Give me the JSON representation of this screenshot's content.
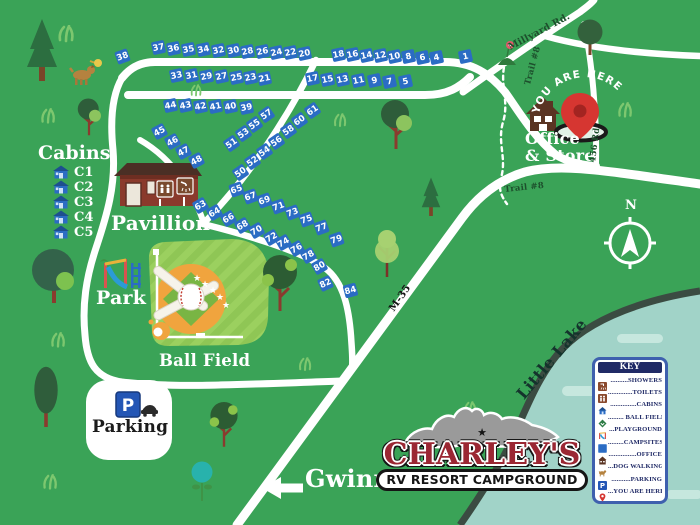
{
  "map": {
    "background_color": "#3aa357",
    "road_color": "#ffffff",
    "campsite_color": "#2b6cc4",
    "lake_fill": "#a1d3c8",
    "lake_shore": "#3b4b42"
  },
  "logo": {
    "name": "CHARLEY'S",
    "tagline": "RV RESORT CAMPGROUND",
    "color": "#9b2733"
  },
  "you_are_here": "YOU ARE HERE",
  "cabins": {
    "title": "Cabins",
    "items": [
      "C1",
      "C2",
      "C3",
      "C4",
      "C5"
    ]
  },
  "key": {
    "title": "KEY",
    "entries": [
      {
        "icon": "shower-icon",
        "label": "..........SHOWERS"
      },
      {
        "icon": "toilets-icon",
        "label": "..............TOILETS"
      },
      {
        "icon": "cabins-icon",
        "label": "...............CABINS"
      },
      {
        "icon": "ball-field-icon",
        "label": "......... BALL FIELD"
      },
      {
        "icon": "playground-icon",
        "label": "...PLAYGROUND"
      },
      {
        "icon": "campsites-icon",
        "label": ".........CAMPSITES"
      },
      {
        "icon": "office-icon",
        "label": "................OFFICE"
      },
      {
        "icon": "dog-walking-icon",
        "label": "...DOG WALKING"
      },
      {
        "icon": "parking-icon",
        "label": "...........PARKING"
      },
      {
        "icon": "you-are-here-icon",
        "label": "...YOU ARE HERE"
      }
    ]
  },
  "place_labels": [
    {
      "name": "pavillion-label",
      "text": "Pavillion",
      "x": 111,
      "y": 213,
      "size": 20
    },
    {
      "name": "park-label",
      "text": "Park",
      "x": 96,
      "y": 289,
      "size": 19
    },
    {
      "name": "ball-field-label",
      "text": "Ball Field",
      "x": 159,
      "y": 352,
      "size": 16.5
    },
    {
      "name": "parking-label",
      "text": "Parking",
      "x": 92,
      "y": 419,
      "size": 17,
      "color": "#1b1b1b"
    },
    {
      "name": "office-store-label",
      "text": "Office\n& Store",
      "x": 525,
      "y": 131,
      "size": 16
    },
    {
      "name": "gwinn-label",
      "text": "Gwinn",
      "x": 305,
      "y": 467,
      "size": 24
    },
    {
      "name": "little-lake-label",
      "text": "Little Lake",
      "x": 514,
      "y": 392,
      "size": 16,
      "rot": -50,
      "color": "#14332c"
    },
    {
      "name": "compass-n-label",
      "text": "N",
      "x": 625,
      "y": 199,
      "size": 13
    }
  ],
  "road_labels": [
    {
      "name": "millyard-rd-label",
      "text": "Millyard Rd.",
      "x": 507,
      "y": 44,
      "size": 9.5,
      "rot": -28,
      "color": "#1d4f2c"
    },
    {
      "name": "trail8-vertical-label",
      "text": "Trail #8",
      "x": 524,
      "y": 84,
      "size": 8.5,
      "rot": -75,
      "color": "#1d4f2c"
    },
    {
      "name": "rd456-label",
      "text": "456 Rd",
      "x": 589,
      "y": 162,
      "size": 8.5,
      "rot": -83,
      "color": "#1d4f2c"
    },
    {
      "name": "trail8-horizontal-label",
      "text": "Trail #8",
      "x": 504,
      "y": 186,
      "size": 8.5,
      "rot": -6,
      "color": "#1d4f2c"
    },
    {
      "name": "m35-label",
      "text": "M-35",
      "x": 388,
      "y": 308,
      "size": 10,
      "rot": -55,
      "color": "#141414"
    }
  ],
  "campsites": [
    [
      38,
      122,
      56,
      -20
    ],
    [
      37,
      158,
      47,
      -12
    ],
    [
      36,
      173,
      48,
      -12
    ],
    [
      35,
      188,
      49,
      -12
    ],
    [
      34,
      203,
      49,
      -12
    ],
    [
      32,
      218,
      50,
      -12
    ],
    [
      30,
      233,
      50,
      -12
    ],
    [
      28,
      247,
      51,
      -12
    ],
    [
      26,
      262,
      51,
      -12
    ],
    [
      24,
      276,
      52,
      -12
    ],
    [
      22,
      290,
      52,
      -12
    ],
    [
      20,
      304,
      53,
      -12
    ],
    [
      18,
      338,
      54,
      -12
    ],
    [
      16,
      352,
      54,
      -12
    ],
    [
      14,
      366,
      55,
      -12
    ],
    [
      12,
      380,
      55,
      -12
    ],
    [
      10,
      394,
      56,
      -12
    ],
    [
      8,
      408,
      56,
      -12
    ],
    [
      6,
      422,
      57,
      -12
    ],
    [
      4,
      436,
      57,
      -12
    ],
    [
      1,
      465,
      56,
      -12
    ],
    [
      33,
      176,
      75,
      -12
    ],
    [
      31,
      191,
      75,
      -12
    ],
    [
      29,
      206,
      76,
      -12
    ],
    [
      27,
      221,
      76,
      -12
    ],
    [
      25,
      236,
      77,
      -12
    ],
    [
      23,
      250,
      77,
      -12
    ],
    [
      21,
      264,
      78,
      -12
    ],
    [
      17,
      312,
      78,
      -12
    ],
    [
      15,
      327,
      79,
      -12
    ],
    [
      13,
      342,
      79,
      -12
    ],
    [
      11,
      358,
      80,
      -12
    ],
    [
      9,
      374,
      80,
      -12
    ],
    [
      7,
      389,
      81,
      -12
    ],
    [
      5,
      405,
      81,
      -12
    ],
    [
      44,
      170,
      105,
      -12
    ],
    [
      43,
      185,
      105,
      -12
    ],
    [
      42,
      200,
      106,
      -12
    ],
    [
      41,
      215,
      106,
      -12
    ],
    [
      40,
      230,
      106,
      -12
    ],
    [
      39,
      246,
      107,
      -12
    ],
    [
      45,
      159,
      131,
      -28
    ],
    [
      46,
      172,
      141,
      -28
    ],
    [
      47,
      183,
      151,
      -28
    ],
    [
      48,
      196,
      160,
      -28
    ],
    [
      51,
      231,
      143,
      -35
    ],
    [
      53,
      243,
      133,
      -35
    ],
    [
      55,
      254,
      124,
      -35
    ],
    [
      57,
      266,
      114,
      -35
    ],
    [
      61,
      312,
      110,
      -35
    ],
    [
      60,
      299,
      120,
      -35
    ],
    [
      58,
      288,
      130,
      -35
    ],
    [
      56,
      276,
      141,
      -35
    ],
    [
      54,
      264,
      151,
      -35
    ],
    [
      52,
      252,
      161,
      -35
    ],
    [
      50,
      240,
      172,
      -35
    ],
    [
      65,
      236,
      189,
      -20
    ],
    [
      67,
      250,
      196,
      -20
    ],
    [
      69,
      264,
      200,
      -20
    ],
    [
      71,
      278,
      206,
      -20
    ],
    [
      73,
      292,
      212,
      -20
    ],
    [
      75,
      306,
      219,
      -20
    ],
    [
      77,
      321,
      227,
      -20
    ],
    [
      79,
      336,
      239,
      -20
    ],
    [
      63,
      200,
      205,
      -30
    ],
    [
      64,
      214,
      212,
      -30
    ],
    [
      66,
      228,
      218,
      -30
    ],
    [
      68,
      242,
      225,
      -30
    ],
    [
      70,
      256,
      230,
      -30
    ],
    [
      72,
      271,
      237,
      -30
    ],
    [
      74,
      283,
      242,
      -30
    ],
    [
      76,
      296,
      248,
      -30
    ],
    [
      78,
      308,
      255,
      -30
    ],
    [
      80,
      319,
      266,
      -30
    ],
    [
      82,
      325,
      283,
      -25
    ],
    [
      84,
      350,
      290,
      -15
    ]
  ],
  "decor": [
    [
      "pine-tree",
      42,
      52,
      1
    ],
    [
      "pine-tree",
      431,
      198,
      0.62
    ],
    [
      "round-tree",
      590,
      40,
      1
    ],
    [
      "two-tone-tree",
      396,
      126,
      1
    ],
    [
      "two-tone-tree",
      89,
      118,
      0.75
    ],
    [
      "blob-tree",
      54,
      278,
      1
    ],
    [
      "tall-tree",
      46,
      400,
      0.9
    ],
    [
      "leaf-tree",
      280,
      285,
      1
    ],
    [
      "leaf-tree",
      224,
      426,
      0.8
    ],
    [
      "light-tree",
      387,
      255,
      1
    ],
    [
      "teal-tree",
      202,
      484,
      1
    ],
    [
      "flower",
      507,
      55,
      1
    ],
    [
      "dog-walker",
      85,
      73,
      1
    ],
    [
      "tuft",
      66,
      36,
      1
    ],
    [
      "tuft",
      48,
      118,
      0.9
    ],
    [
      "tuft",
      340,
      122,
      0.8
    ],
    [
      "tuft",
      625,
      112,
      0.9
    ],
    [
      "tuft",
      58,
      342,
      0.9
    ],
    [
      "tuft",
      305,
      366,
      0.8
    ],
    [
      "tuft",
      50,
      484,
      0.9
    ],
    [
      "tuft",
      470,
      410,
      0.8
    ],
    [
      "tuft",
      196,
      92,
      0.7
    ]
  ]
}
